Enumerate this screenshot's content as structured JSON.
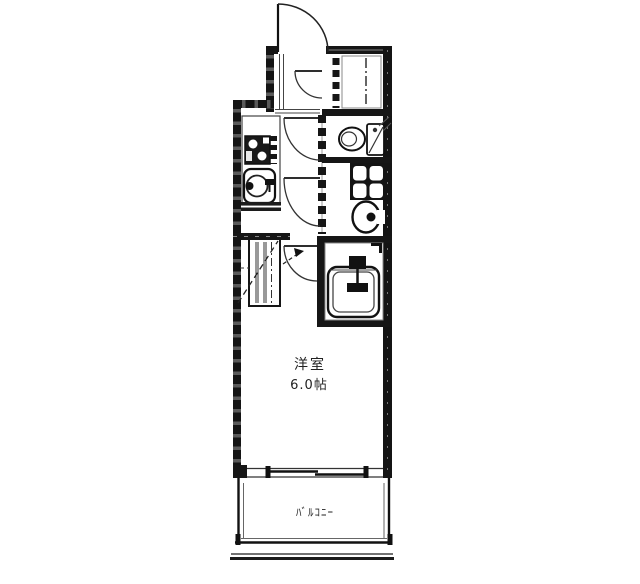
{
  "floor_plan": {
    "room_label": "洋室",
    "room_size_label": "6.0帖",
    "balcony_label": "ﾊﾞﾙｺﾆｰ",
    "colors": {
      "background": "#ffffff",
      "wall": "#161616",
      "line": "#333333"
    },
    "fixtures": [
      "entry-door",
      "shoe-storage",
      "kitchen-stove",
      "kitchen-sink",
      "toilet",
      "washing-machine-pan",
      "washbasin",
      "bathtub",
      "closet",
      "sliding-window",
      "balcony"
    ]
  }
}
